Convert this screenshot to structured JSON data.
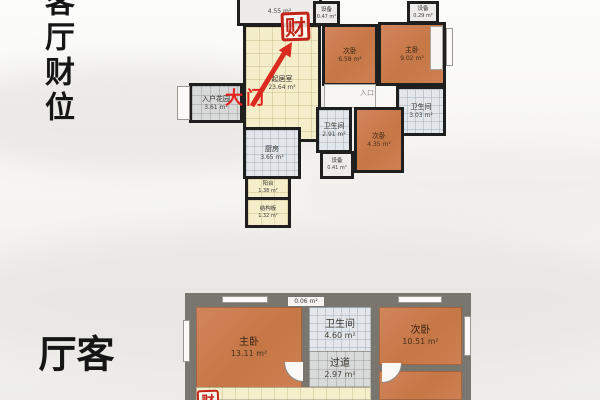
{
  "calligraphy": {
    "top_vertical": "客厅财位",
    "bottom_vertical": "客厅"
  },
  "colors": {
    "stamp_red": "#c3241a",
    "door_red": "#e8231d",
    "arrow_red": "#db2b1e",
    "bedroom_orange": "#c97a4e",
    "living_cream": "#f5eecb",
    "tile_gray": "#e3e7eb",
    "wall_dark": "#1f1f1f",
    "wall_gray": "#79766f"
  },
  "plan1": {
    "stamp": "财",
    "door_label": "大门",
    "entrance_label": "入口",
    "rooms": {
      "balcony_top": {
        "area": "4.55 m²"
      },
      "equip_left": {
        "name": "设备",
        "area": "0.47 m²"
      },
      "equip_right": {
        "name": "设备",
        "area": "0.29 m²"
      },
      "living": {
        "name": "起居室",
        "area": "23.64 m²"
      },
      "entry_garden": {
        "name": "入户花园",
        "area": "3.61 m²"
      },
      "kitchen": {
        "name": "厨房",
        "area": "3.65 m²"
      },
      "balcony": {
        "name": "阳台",
        "area": "1.38 m²"
      },
      "structure_board": {
        "name": "结构板",
        "area": "1.32 m²"
      },
      "bedroom_a": {
        "name": "次卧",
        "area": "6.58 m²"
      },
      "master": {
        "name": "主卧",
        "area": "9.02 m²"
      },
      "bath_small": {
        "name": "卫生间",
        "area": "2.91 m²"
      },
      "bedroom_b": {
        "name": "次卧",
        "area": "4.35 m²"
      },
      "equip_mid": {
        "name": "设备",
        "area": "0.41 m²"
      },
      "bath_right": {
        "name": "卫生间",
        "area": "3.03 m²"
      }
    }
  },
  "plan2": {
    "stamp": "财",
    "rooms": {
      "master": {
        "name": "主卧",
        "area": "13.11 m²"
      },
      "bath": {
        "name": "卫生间",
        "area": "4.60 m²"
      },
      "duct": {
        "area": "0.06 m²"
      },
      "bedroom": {
        "name": "次卧",
        "area": "10.51 m²"
      },
      "corridor": {
        "name": "过道",
        "area": "2.97 m²"
      }
    }
  }
}
